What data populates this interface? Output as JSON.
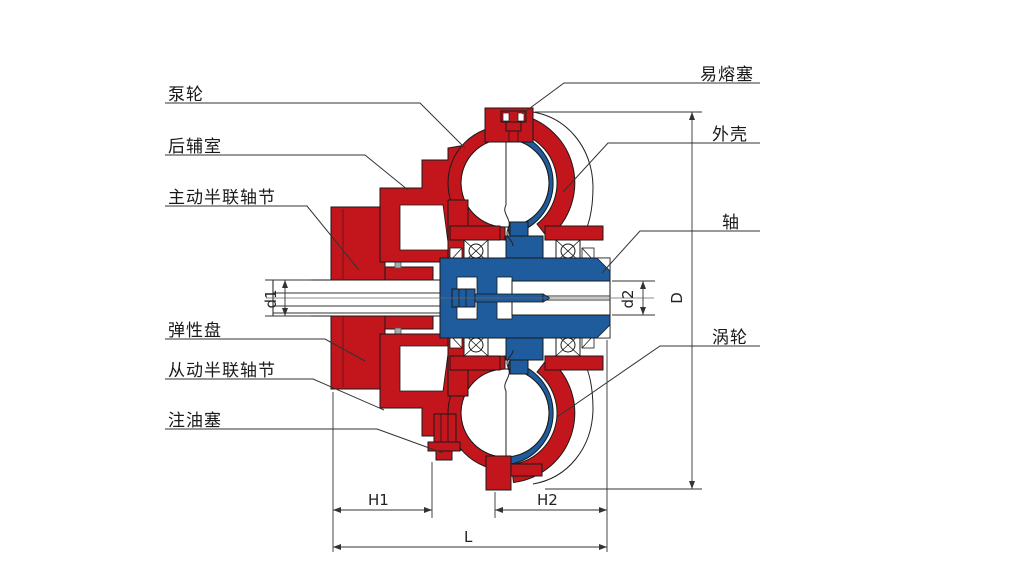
{
  "diagram": {
    "type": "fluid-coupling-cross-section",
    "colors": {
      "driving_parts_red": "#C3161C",
      "driven_parts_blue": "#1E5C9E",
      "elastic_disc_grey": "#A8AAB0",
      "outline": "#1A1A1A",
      "leader_line": "#333333",
      "background": "#FFFFFF"
    },
    "labels_left": [
      {
        "text": "泵轮"
      },
      {
        "text": "后辅室"
      },
      {
        "text": "主动半联轴节"
      },
      {
        "text": "弹性盘"
      },
      {
        "text": "从动半联轴节"
      },
      {
        "text": "注油塞"
      }
    ],
    "labels_right": [
      {
        "text": "易熔塞"
      },
      {
        "text": "外壳"
      },
      {
        "text": "轴"
      },
      {
        "text": "涡轮"
      }
    ],
    "dimensions": {
      "d1": "d1",
      "d2": "d2",
      "D": "D",
      "H1": "H1",
      "H2": "H2",
      "L": "L"
    }
  }
}
